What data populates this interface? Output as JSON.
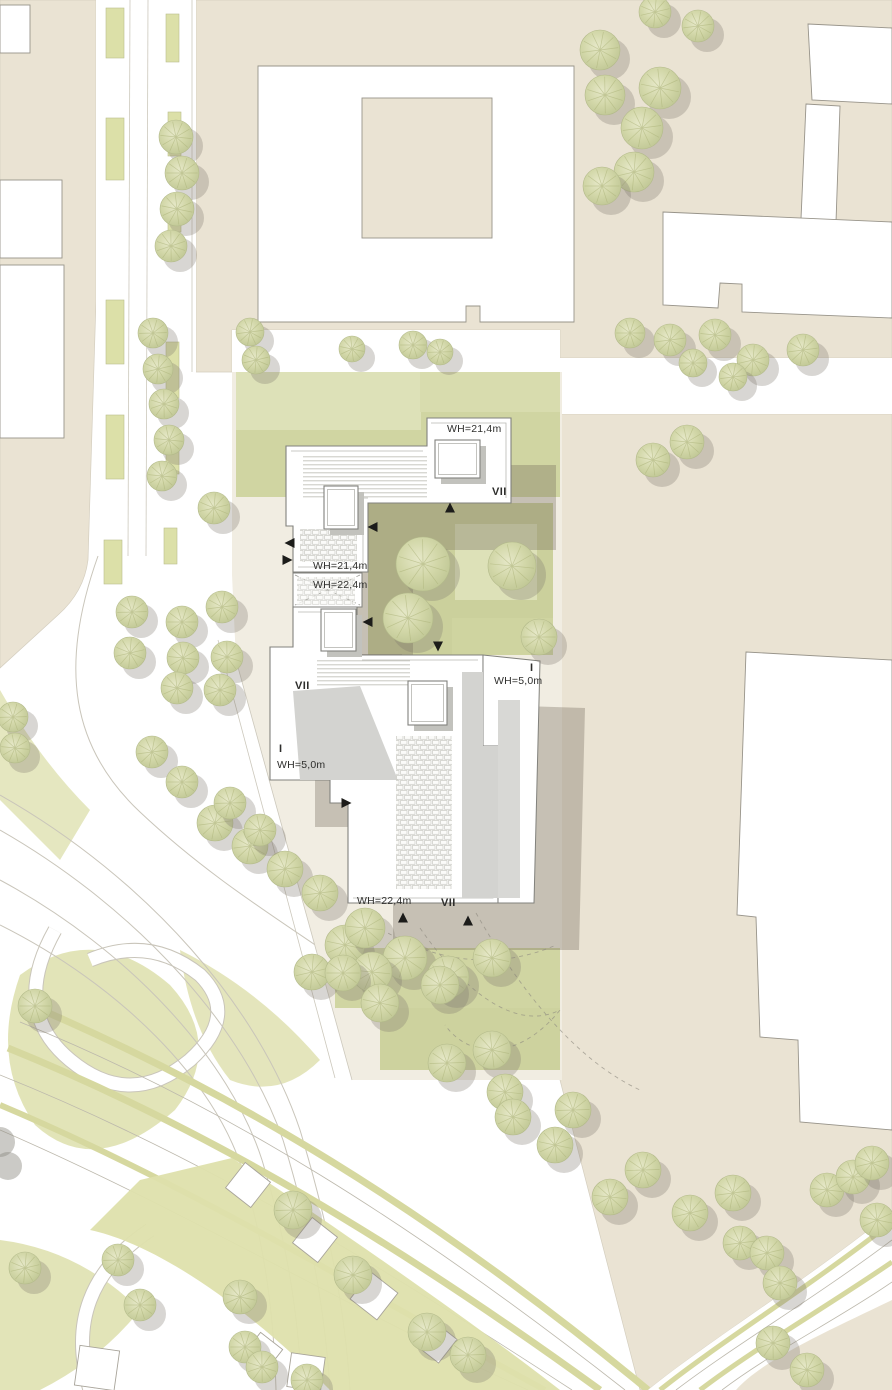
{
  "plan": {
    "type": "architectural-site-plan",
    "height_labels": [
      {
        "id": "b1-top-wh",
        "text": "WH=21,4m",
        "x": 447,
        "y": 432,
        "anchor": "start"
      },
      {
        "id": "b1-left-wh",
        "text": "WH=21,4m",
        "x": 313,
        "y": 569,
        "anchor": "start"
      },
      {
        "id": "connector-wh",
        "text": "WH=22,4m",
        "x": 313,
        "y": 588,
        "anchor": "start"
      },
      {
        "id": "b2-right-wh",
        "text": "WH=5,0m",
        "x": 494,
        "y": 684,
        "anchor": "start"
      },
      {
        "id": "b2-left-wh",
        "text": "WH=5,0m",
        "x": 277,
        "y": 768,
        "anchor": "start"
      },
      {
        "id": "b2-bottom-wh",
        "text": "WH=22,4m",
        "x": 357,
        "y": 904,
        "anchor": "start"
      }
    ],
    "storey_labels": [
      {
        "id": "b1-storeys",
        "text": "VII",
        "x": 492,
        "y": 495
      },
      {
        "id": "b2-tower-storeys",
        "text": "VII",
        "x": 295,
        "y": 689
      },
      {
        "id": "b2-right-storeys",
        "text": "I",
        "x": 530,
        "y": 671
      },
      {
        "id": "b2-left-storeys",
        "text": "I",
        "x": 279,
        "y": 752
      },
      {
        "id": "b2-bottom-storeys",
        "text": "VII",
        "x": 441,
        "y": 906
      }
    ],
    "entrance_arrows": [
      {
        "x": 450,
        "y": 508,
        "dir": "up"
      },
      {
        "x": 373,
        "y": 527,
        "dir": "left"
      },
      {
        "x": 290,
        "y": 543,
        "dir": "left"
      },
      {
        "x": 287,
        "y": 560,
        "dir": "right"
      },
      {
        "x": 368,
        "y": 622,
        "dir": "left"
      },
      {
        "x": 438,
        "y": 646,
        "dir": "down"
      },
      {
        "x": 346,
        "y": 803,
        "dir": "right"
      },
      {
        "x": 403,
        "y": 918,
        "dir": "up"
      },
      {
        "x": 468,
        "y": 921,
        "dir": "up"
      }
    ],
    "skylights": [
      {
        "x": 435,
        "y": 440,
        "w": 45,
        "h": 38
      },
      {
        "x": 324,
        "y": 486,
        "w": 34,
        "h": 43
      },
      {
        "x": 321,
        "y": 609,
        "w": 35,
        "h": 42
      },
      {
        "x": 408,
        "y": 681,
        "w": 39,
        "h": 44
      }
    ],
    "trees": [
      [
        176,
        137,
        17
      ],
      [
        182,
        173,
        17
      ],
      [
        177,
        209,
        17
      ],
      [
        171,
        246,
        16
      ],
      [
        153,
        333,
        15
      ],
      [
        158,
        369,
        15
      ],
      [
        164,
        404,
        15
      ],
      [
        169,
        440,
        15
      ],
      [
        162,
        476,
        15
      ],
      [
        214,
        508,
        16
      ],
      [
        250,
        332,
        14
      ],
      [
        256,
        360,
        14
      ],
      [
        352,
        349,
        13
      ],
      [
        413,
        345,
        14
      ],
      [
        440,
        352,
        13
      ],
      [
        600,
        50,
        20
      ],
      [
        660,
        88,
        21
      ],
      [
        605,
        95,
        20
      ],
      [
        642,
        128,
        21
      ],
      [
        634,
        172,
        20
      ],
      [
        602,
        186,
        19
      ],
      [
        655,
        12,
        16
      ],
      [
        698,
        26,
        16
      ],
      [
        630,
        333,
        15
      ],
      [
        670,
        340,
        16
      ],
      [
        715,
        335,
        16
      ],
      [
        753,
        360,
        16
      ],
      [
        803,
        350,
        16
      ],
      [
        693,
        363,
        14
      ],
      [
        733,
        377,
        14
      ],
      [
        653,
        460,
        17
      ],
      [
        687,
        442,
        17
      ],
      [
        423,
        564,
        27
      ],
      [
        408,
        618,
        25
      ],
      [
        512,
        566,
        24
      ],
      [
        539,
        637,
        18
      ],
      [
        345,
        945,
        20
      ],
      [
        365,
        928,
        20
      ],
      [
        405,
        958,
        22
      ],
      [
        372,
        972,
        20
      ],
      [
        448,
        977,
        21
      ],
      [
        492,
        958,
        19
      ],
      [
        215,
        823,
        18
      ],
      [
        250,
        846,
        18
      ],
      [
        285,
        869,
        18
      ],
      [
        320,
        893,
        18
      ],
      [
        312,
        972,
        18
      ],
      [
        343,
        973,
        18
      ],
      [
        380,
        1003,
        19
      ],
      [
        440,
        985,
        19
      ],
      [
        447,
        1063,
        19
      ],
      [
        492,
        1050,
        19
      ],
      [
        505,
        1092,
        18
      ],
      [
        513,
        1117,
        18
      ],
      [
        555,
        1145,
        18
      ],
      [
        573,
        1110,
        18
      ],
      [
        610,
        1197,
        18
      ],
      [
        643,
        1170,
        18
      ],
      [
        690,
        1213,
        18
      ],
      [
        733,
        1193,
        18
      ],
      [
        740,
        1243,
        17
      ],
      [
        767,
        1253,
        17
      ],
      [
        780,
        1283,
        17
      ],
      [
        827,
        1190,
        17
      ],
      [
        853,
        1177,
        17
      ],
      [
        872,
        1163,
        17
      ],
      [
        877,
        1220,
        17
      ],
      [
        773,
        1343,
        17
      ],
      [
        807,
        1370,
        17
      ],
      [
        293,
        1210,
        19
      ],
      [
        353,
        1275,
        19
      ],
      [
        427,
        1332,
        19
      ],
      [
        468,
        1355,
        18
      ],
      [
        240,
        1297,
        17
      ],
      [
        245,
        1347,
        16
      ],
      [
        262,
        1367,
        16
      ],
      [
        307,
        1380,
        16
      ],
      [
        132,
        612,
        16
      ],
      [
        130,
        653,
        16
      ],
      [
        182,
        622,
        16
      ],
      [
        183,
        658,
        16
      ],
      [
        177,
        688,
        16
      ],
      [
        222,
        607,
        16
      ],
      [
        227,
        657,
        16
      ],
      [
        220,
        690,
        16
      ],
      [
        152,
        752,
        16
      ],
      [
        182,
        782,
        16
      ],
      [
        230,
        803,
        16
      ],
      [
        260,
        830,
        16
      ],
      [
        13,
        717,
        15
      ],
      [
        15,
        748,
        15
      ],
      [
        35,
        1006,
        17
      ],
      [
        25,
        1268,
        16
      ],
      [
        118,
        1260,
        16
      ],
      [
        140,
        1305,
        16
      ]
    ],
    "gray_trees": [
      [
        0,
        1142,
        15
      ],
      [
        8,
        1166,
        14
      ]
    ],
    "houses": [
      [
        248,
        1185,
        32,
        38
      ],
      [
        315,
        1240,
        32,
        38
      ],
      [
        374,
        1296,
        34,
        38
      ],
      [
        263,
        1352,
        28,
        38
      ],
      [
        436,
        1342,
        30,
        38
      ],
      [
        97,
        1368,
        40,
        8
      ],
      [
        306,
        1372,
        34,
        8
      ]
    ],
    "median_strips": [
      [
        106,
        8,
        18,
        50
      ],
      [
        106,
        118,
        18,
        62
      ],
      [
        106,
        300,
        18,
        64
      ],
      [
        106,
        415,
        18,
        64
      ],
      [
        104,
        540,
        18,
        44
      ],
      [
        166,
        14,
        13,
        48
      ],
      [
        168,
        112,
        13,
        44
      ],
      [
        168,
        196,
        13,
        36
      ],
      [
        166,
        342,
        13,
        56
      ],
      [
        166,
        430,
        13,
        44
      ],
      [
        164,
        528,
        13,
        36
      ]
    ],
    "colors": {
      "context_beige": "#eae3d3",
      "site_ground": "#f1ede2",
      "lawn": "#d0d5a2",
      "lawn_light": "#dde1b8",
      "median_green": "#dce0a8",
      "tram_green": "#d6d89f",
      "building_white": "#ffffff",
      "outline_gray": "#98948a",
      "roof_shadow": "#d3d3d0",
      "cast_shadow": "rgba(115,106,92,0.34)",
      "tree_green": "#ccd1a0",
      "text": "#2e2e2c"
    }
  }
}
